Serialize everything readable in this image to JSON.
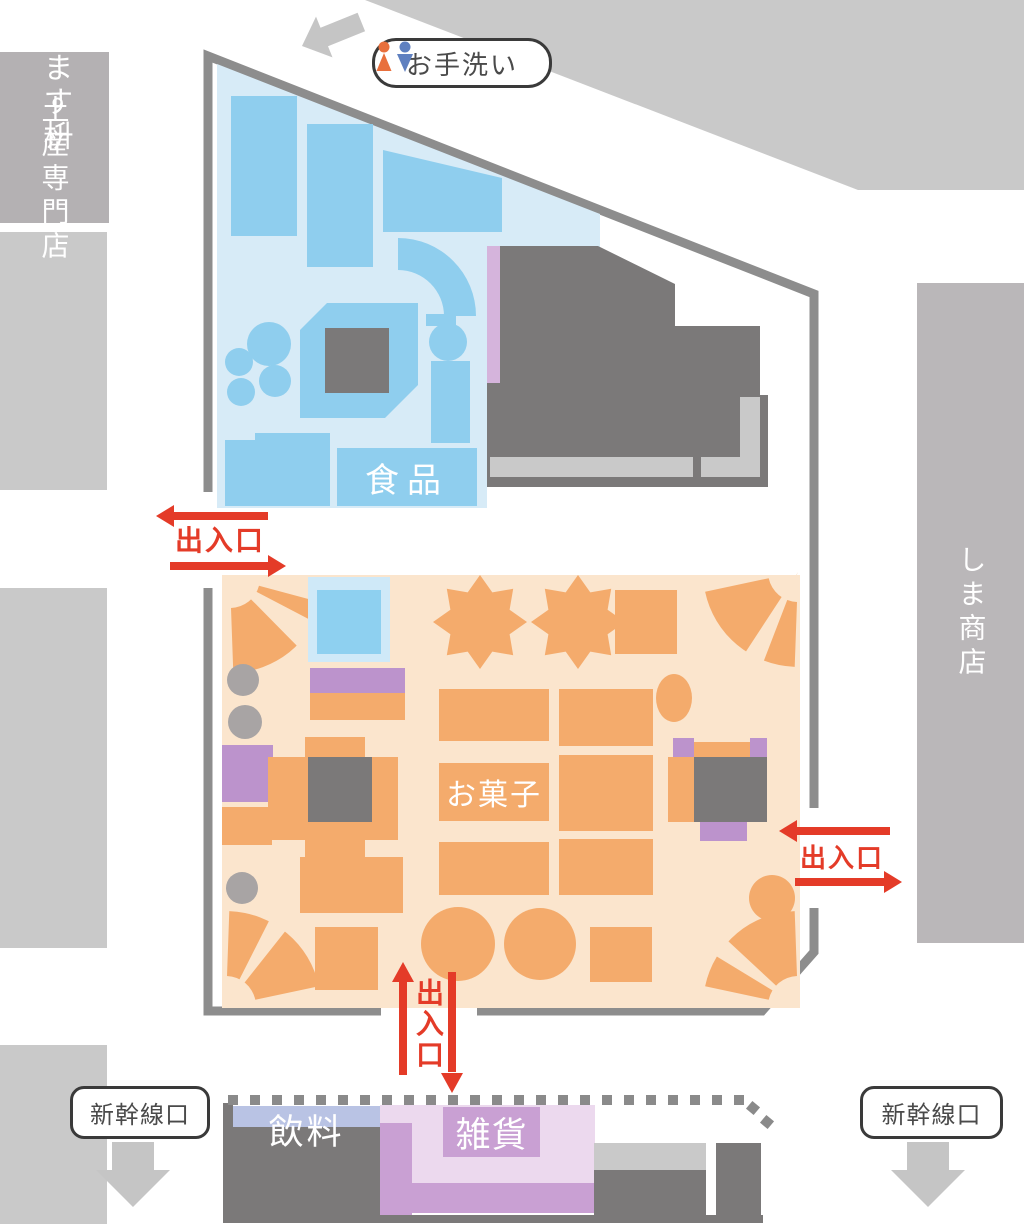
{
  "map": {
    "surrounding_shops": {
      "sake": "酒ます枡",
      "souvenir": "土産専門店",
      "shima": "しま商店"
    },
    "areas": {
      "food": "食品",
      "sweets": "お菓子",
      "drinks": "飲料",
      "goods": "雑貨"
    },
    "signs": {
      "restroom": "お手洗い",
      "entrance": "出入口",
      "shinkansen_gate": "新幹線口"
    }
  },
  "icons": {
    "restroom_female": "female-person-icon",
    "restroom_male": "male-person-icon",
    "restroom_direction": "arrow-up-left-icon",
    "shinkansen_direction": "arrow-down-icon",
    "entrance_direction": "red-double-arrow-icon"
  },
  "colors": {
    "wall": "#8d8d8d",
    "block_light": "#c9c9c9",
    "block_sake": "#b4b1b3",
    "block_shima": "#bab7b9",
    "dark_gray": "#7b7979",
    "counter": "#c9c9c9",
    "blue_bg": "#d7ebf7",
    "blue_fixture": "#8fceee",
    "blue_frame": "#cfe9f8",
    "blue_inner": "#8ed0f0",
    "orange_bg": "#fbe5cd",
    "orange_fixture": "#f4ab6c",
    "purple": "#bc93cc",
    "purple_strip": "#d5b4dc",
    "pink": "#ecd9ee",
    "purple_mid": "#c9a0d3",
    "lavender": "#b9c3e4",
    "red": "#e43b28",
    "gray_circle": "#a8a4a4",
    "arrow_gray": "#c5c5c5",
    "dot_gray": "#8a8a8a",
    "pill_border": "#3a3a3a",
    "text_dark": "#4a4a4a",
    "female_icon": "#e8703d",
    "male_icon": "#5f80c0"
  }
}
